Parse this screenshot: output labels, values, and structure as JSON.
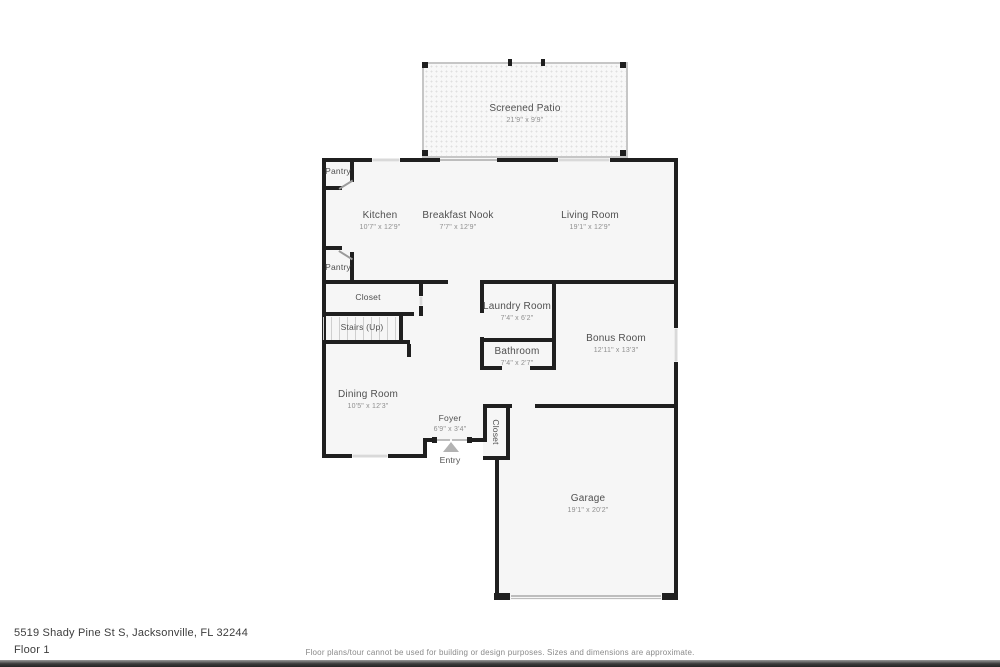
{
  "address": "5519 Shady Pine St S, Jacksonville, FL 32244",
  "floor_label": "Floor 1",
  "disclaimer": "Floor plans/tour cannot be used for building or design purposes. Sizes and dimensions are approximate.",
  "rooms": {
    "screened_patio": {
      "label": "Screened Patio",
      "dims": "21'9\" x 9'9\""
    },
    "kitchen": {
      "label": "Kitchen",
      "dims": "10'7\" x 12'9\""
    },
    "breakfast_nook": {
      "label": "Breakfast Nook",
      "dims": "7'7\" x 12'9\""
    },
    "living_room": {
      "label": "Living Room",
      "dims": "19'1\" x 12'9\""
    },
    "pantry_upper": {
      "label": "Pantry"
    },
    "pantry_lower": {
      "label": "Pantry"
    },
    "hall_closet": {
      "label": "Closet"
    },
    "stairs": {
      "label": "Stairs (Up)"
    },
    "laundry_room": {
      "label": "Laundry Room",
      "dims": "7'4\" x 6'2\""
    },
    "bathroom": {
      "label": "Bathroom",
      "dims": "7'4\" x 2'7\""
    },
    "bonus_room": {
      "label": "Bonus Room",
      "dims": "12'11\" x 13'3\""
    },
    "dining_room": {
      "label": "Dining Room",
      "dims": "10'5\" x 12'3\""
    },
    "foyer": {
      "label": "Foyer",
      "dims": "6'9\" x 3'4\""
    },
    "entry": {
      "label": "Entry"
    },
    "entry_closet": {
      "label": "Closet"
    },
    "garage": {
      "label": "Garage",
      "dims": "19'1\" x 20'2\""
    }
  },
  "colors": {
    "wall": "#1f1f1f",
    "window": "#d9d9d9",
    "floor": "#f6f6f6"
  }
}
